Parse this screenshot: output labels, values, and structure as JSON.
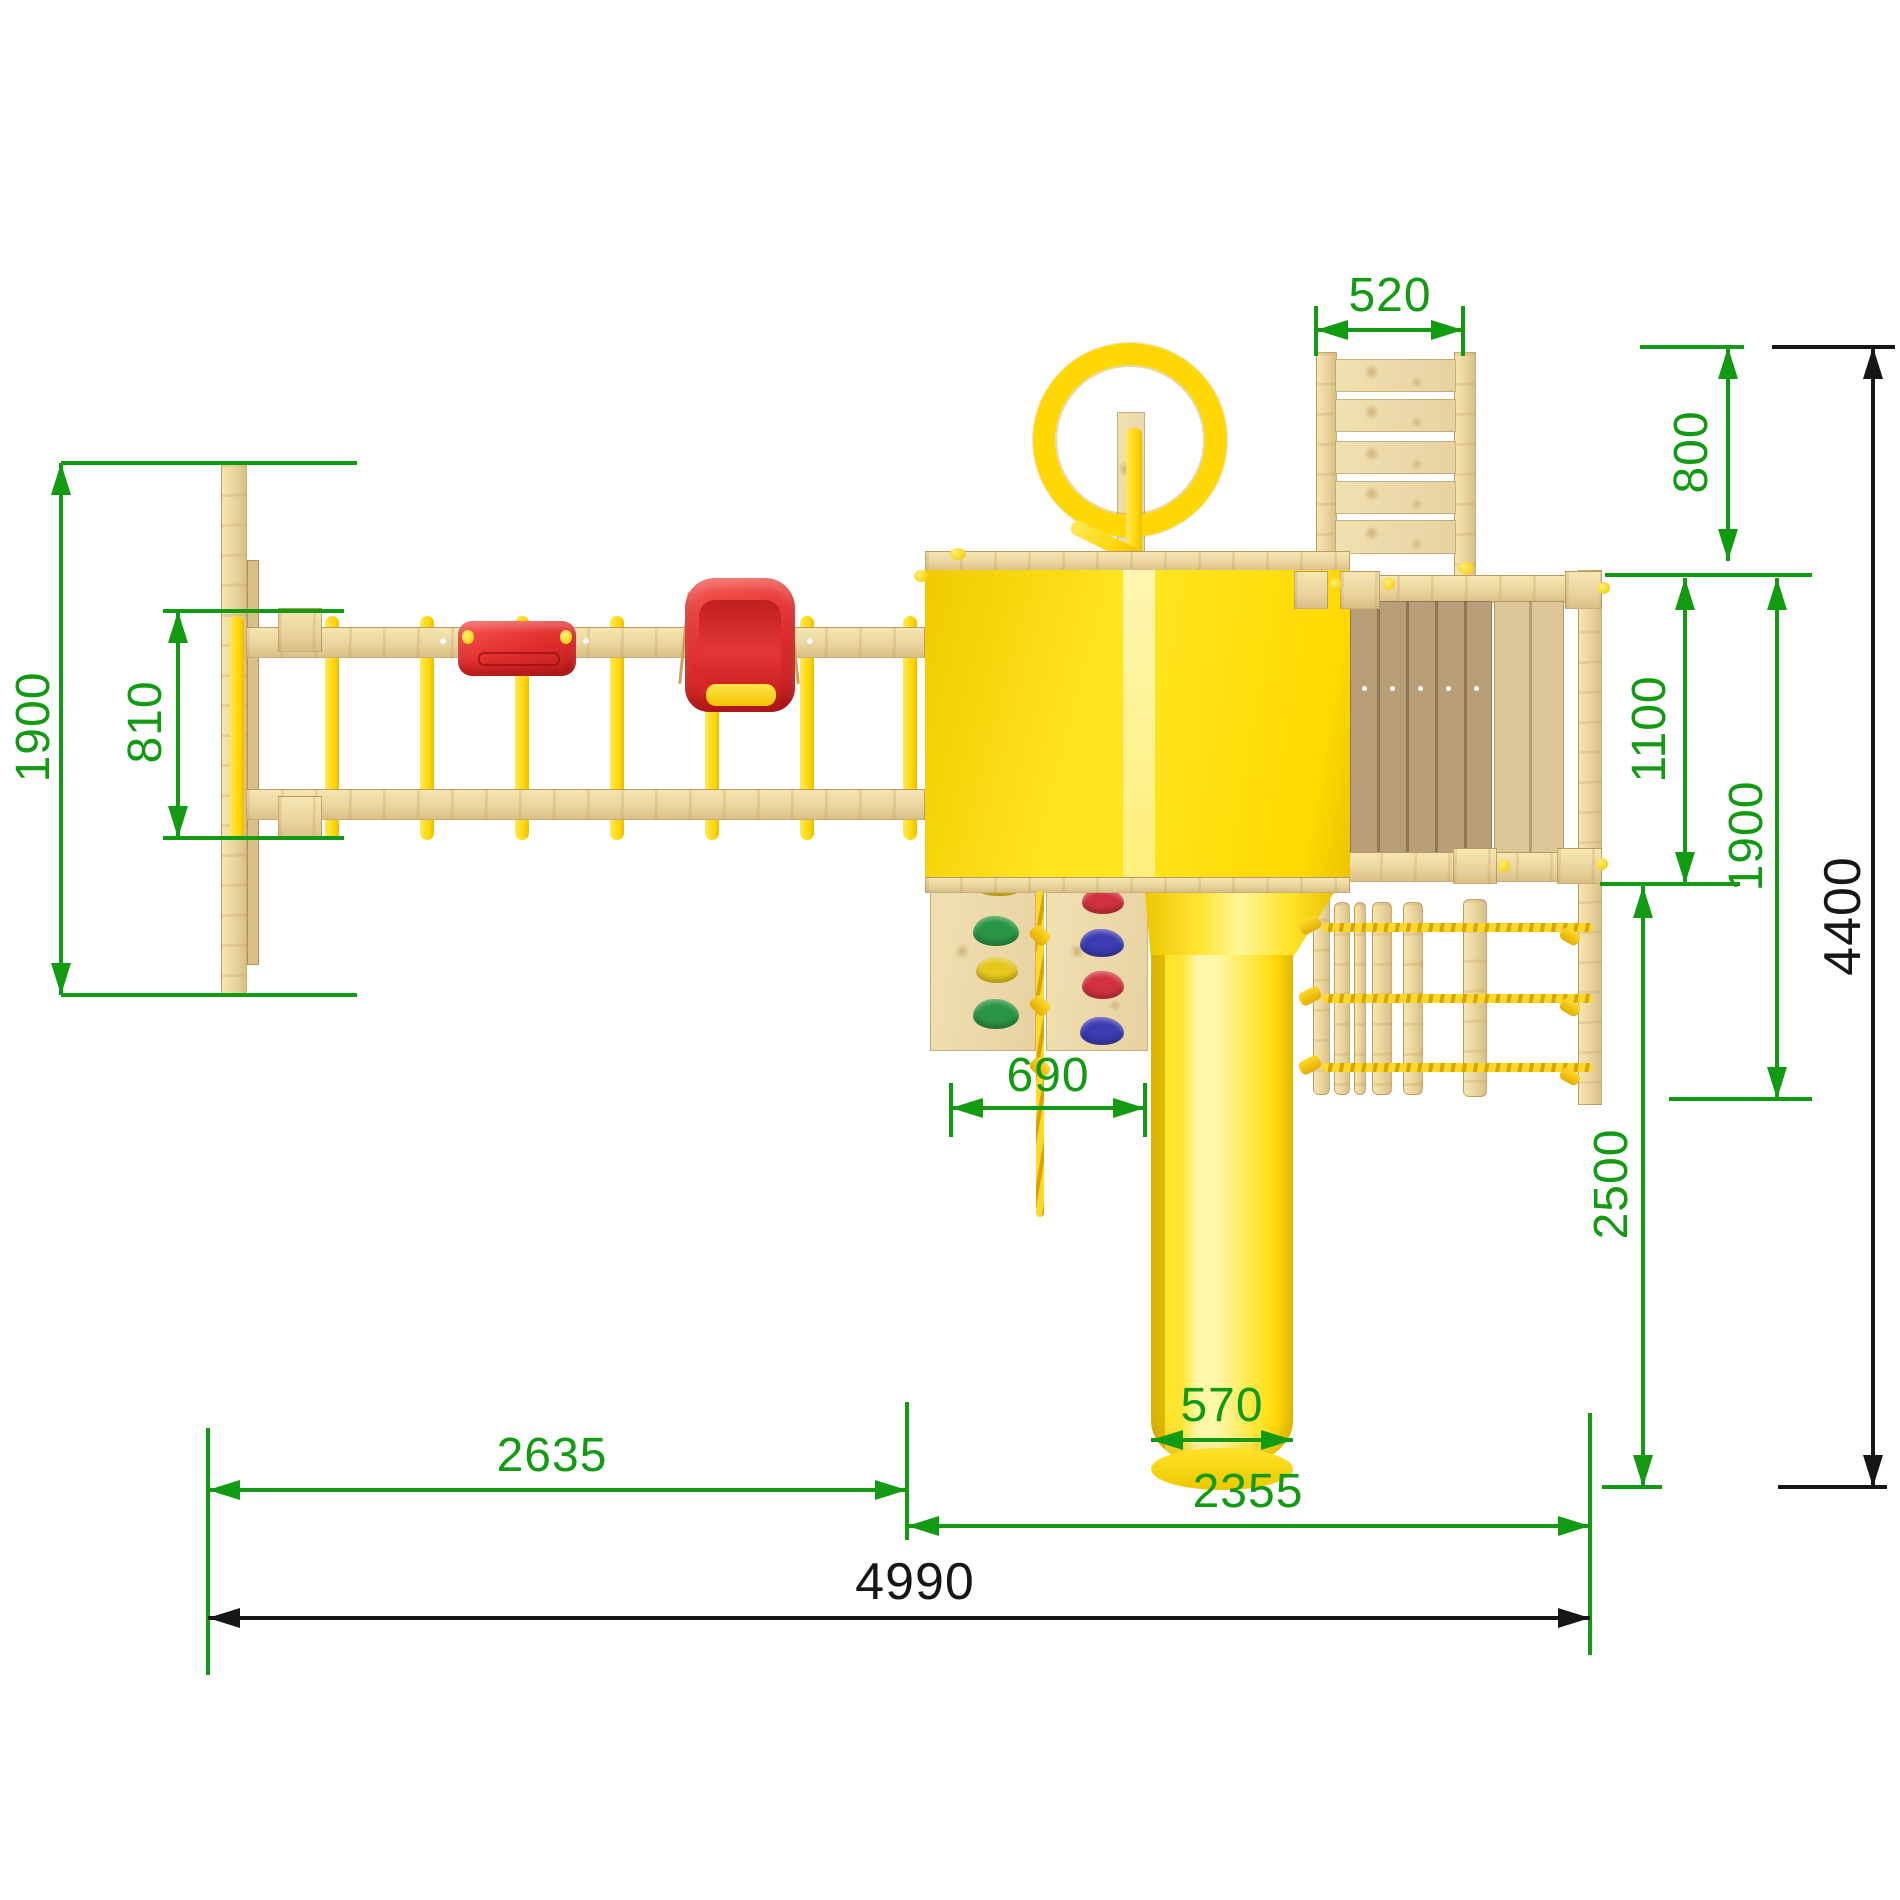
{
  "drawing": {
    "view": "top",
    "background": "#ffffff"
  },
  "colors": {
    "dimension_green": "#129a12",
    "dimension_black": "#161616",
    "wood_light": "#f6e6b2",
    "wood_mid": "#e9d39d",
    "wood_dark": "#b89f77",
    "plastic_yellow": "#ffdf00",
    "slide_yellow": "#ffe635",
    "rope_yellow": "#ffd622",
    "seat_red": "#e02c2c",
    "hold_green": "#2a9545",
    "hold_yellow": "#e5c81e",
    "hold_red": "#d23240",
    "hold_blue": "#3c3cb4"
  },
  "dimensions": {
    "swing_frame_depth": "1900",
    "swing_beam_gap": "810",
    "ladder_width": "520",
    "ladder_length": "800",
    "platform_depth": "1100",
    "platform_total_depth": "1900",
    "overall_depth": "4400",
    "climbing_wall_width": "690",
    "lower_extension_depth": "2500",
    "slide_width": "570",
    "swing_section_length": "2635",
    "tower_section_length": "2355",
    "overall_length": "4990"
  }
}
